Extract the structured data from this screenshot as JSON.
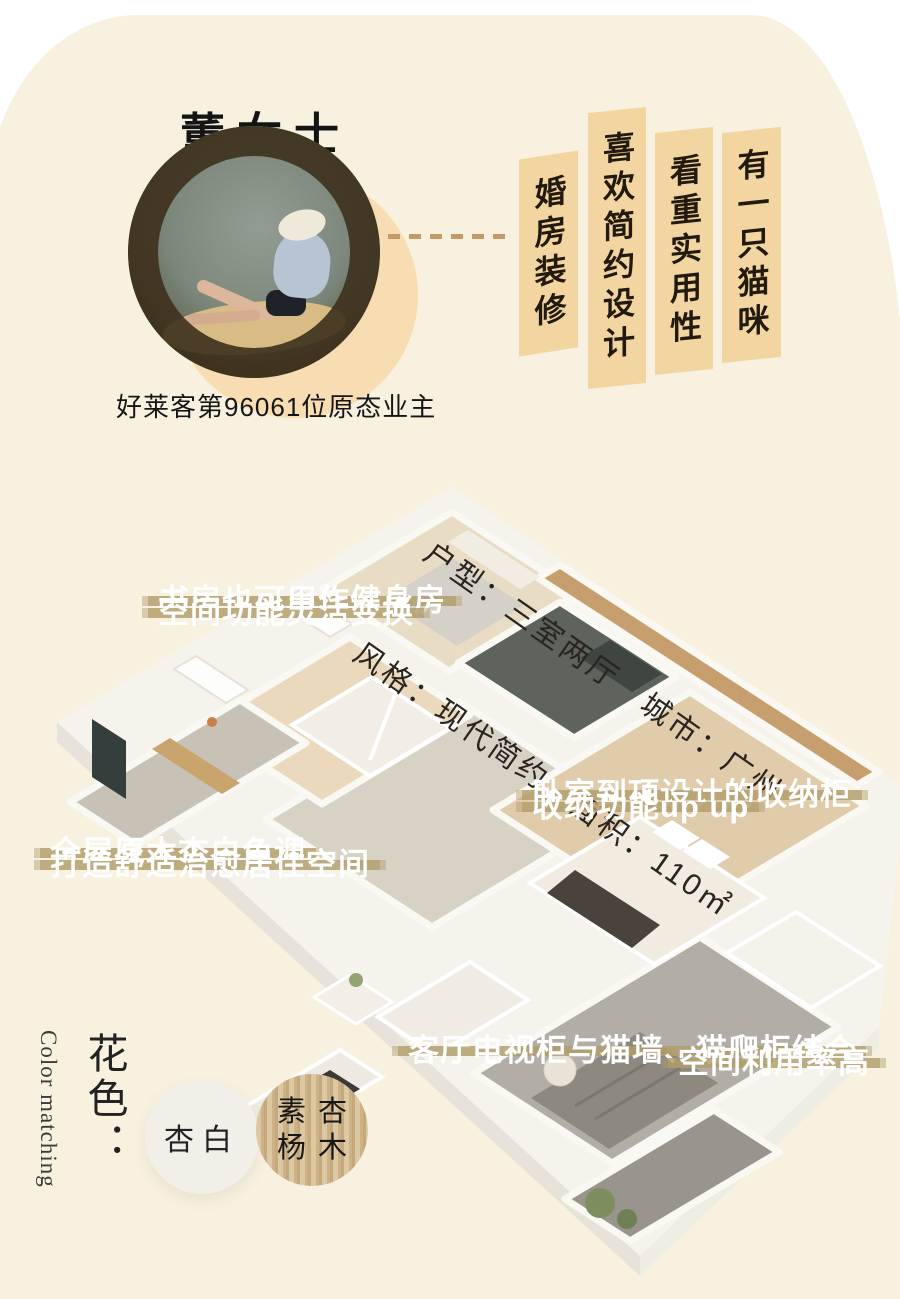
{
  "profile": {
    "title": "董女士",
    "caption": "好莱客第96061位原态业主",
    "tags": [
      "婚房装修",
      "喜欢简约设计",
      "看重实用性",
      "有一只猫咪"
    ]
  },
  "house_info": {
    "line1": "户型：三室两厅　城市：广州",
    "line2": "风格：现代简约　面积：110㎡",
    "layout": "三室两厅",
    "city": "广州",
    "style": "现代简约",
    "area": "110㎡"
  },
  "annotations": [
    {
      "line1": "书房也可用作健身房",
      "line2": "空间功能灵活变换"
    },
    {
      "line1": "全屋原木杏白色调",
      "line2": "打造舒适治愈居住空间"
    },
    {
      "line1": "卧室到顶设计的收纳柜",
      "line2": "收纳功能up up"
    },
    {
      "line1": "客厅电视柜与猫墙、猫爬柜结合",
      "line2": "空间利用率高"
    }
  ],
  "color_section": {
    "label_cn": "花色：",
    "label_en": "Color matching",
    "swatches": [
      {
        "name": "杏白",
        "type": "solid",
        "color": "#f1efe8"
      },
      {
        "name": "素杏杨木",
        "line1": "素杏",
        "line2": "杨木",
        "type": "wood",
        "color": "#d2ba92"
      }
    ]
  },
  "palette": {
    "page_bg": "#ffffff",
    "blob_bg": "#f8f1e0",
    "tag_bg": "#f3d5a2",
    "tag_text": "#221a0e",
    "strip_bg": "#b29e6b",
    "strip_text": "#ffffff",
    "peach_circle": "#f8dcb2",
    "dashed_line": "#c49a66"
  }
}
